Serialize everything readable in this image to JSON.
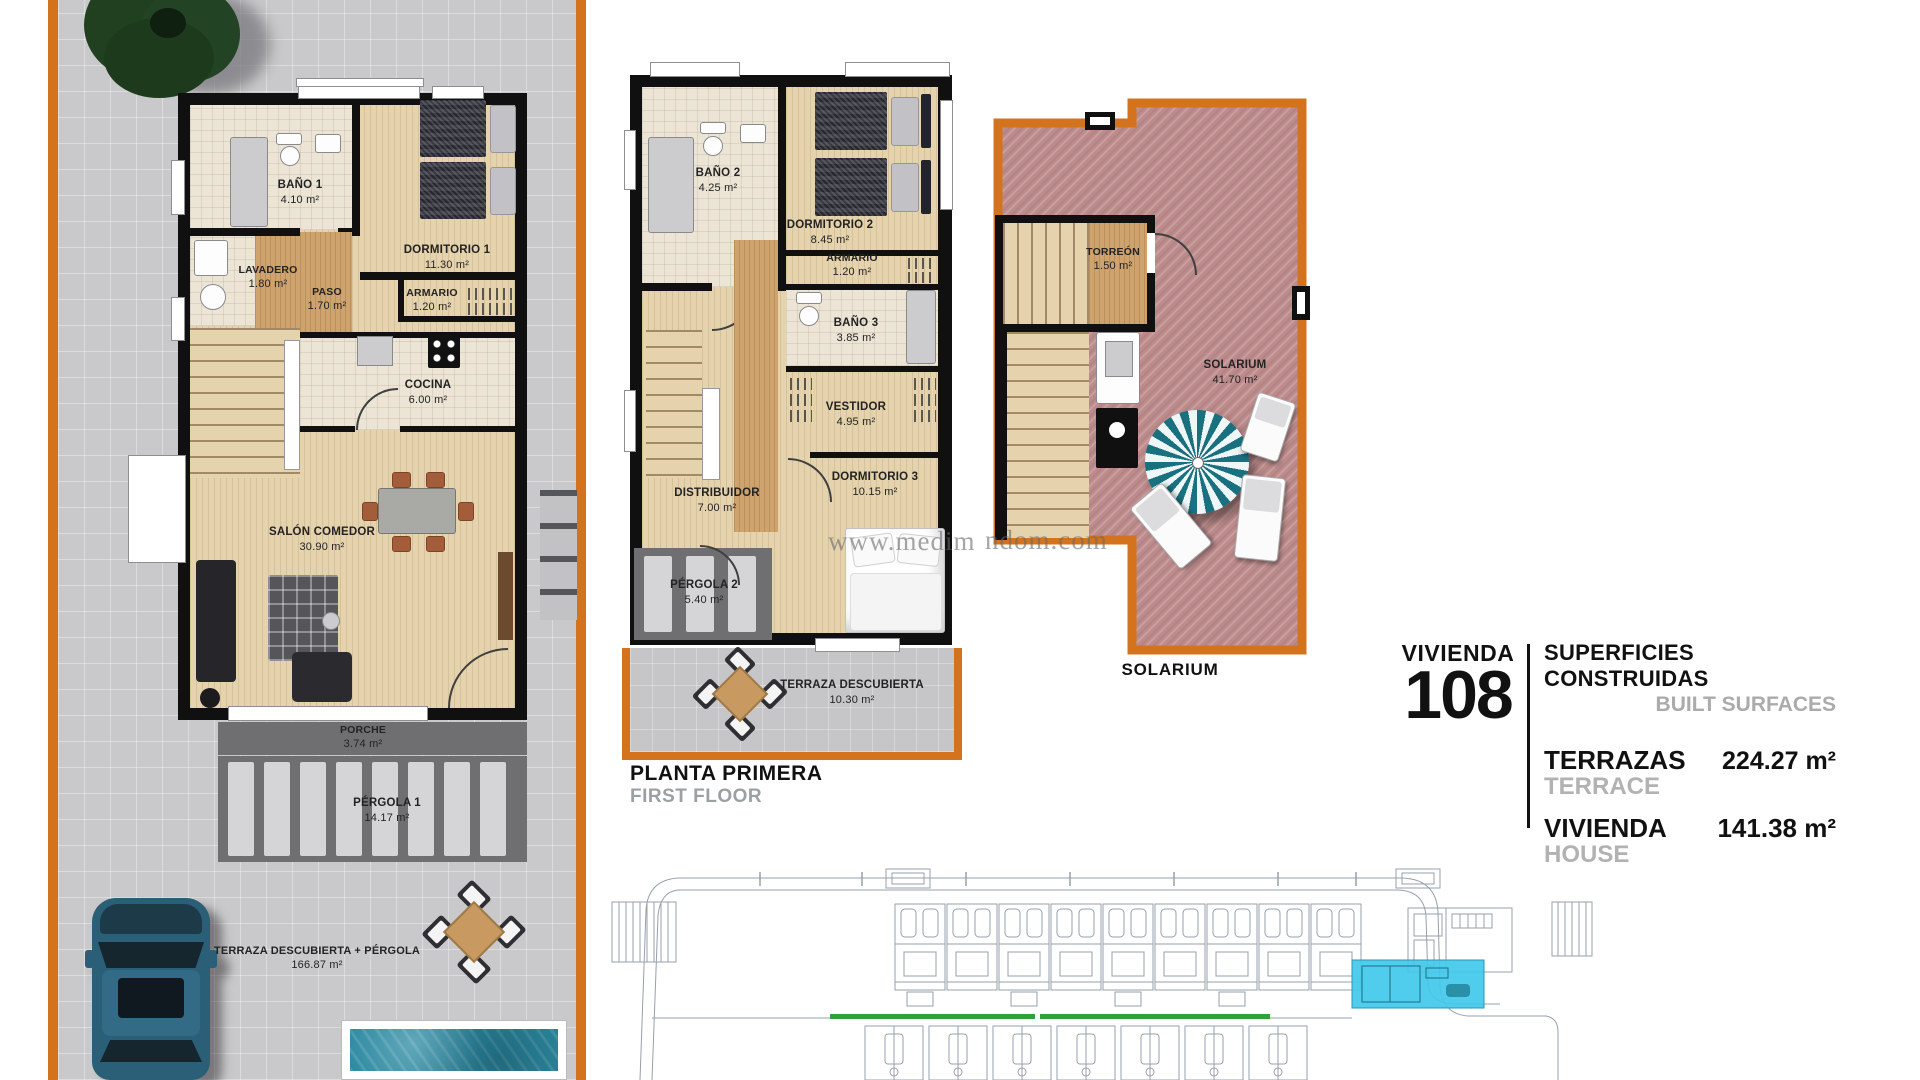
{
  "watermark": {
    "left": "www.medim",
    "right": "ndom.com"
  },
  "ground_floor": {
    "rooms": [
      {
        "name": "BAÑO 1",
        "area": "4.10 m²"
      },
      {
        "name": "LAVADERO",
        "area": "1.80 m²"
      },
      {
        "name": "PASO",
        "area": "1.70 m²"
      },
      {
        "name": "DORMITORIO 1",
        "area": "11.30 m²"
      },
      {
        "name": "ARMARIO",
        "area": "1.20 m²"
      },
      {
        "name": "COCINA",
        "area": "6.00 m²"
      },
      {
        "name": "SALÓN COMEDOR",
        "area": "30.90 m²"
      },
      {
        "name": "PORCHE",
        "area": "3.74 m²"
      },
      {
        "name": "PÉRGOLA 1",
        "area": "14.17 m²"
      },
      {
        "name": "TERRAZA DESCUBIERTA + PÉRGOLA",
        "area": "166.87 m²"
      }
    ]
  },
  "first_floor": {
    "title": "PLANTA PRIMERA",
    "title_en": "FIRST FLOOR",
    "rooms": [
      {
        "name": "BAÑO 2",
        "area": "4.25 m²"
      },
      {
        "name": "DORMITORIO 2",
        "area": "8.45 m²"
      },
      {
        "name": "ARMARIO",
        "area": "1.20 m²"
      },
      {
        "name": "BAÑO 3",
        "area": "3.85 m²"
      },
      {
        "name": "VESTIDOR",
        "area": "4.95 m²"
      },
      {
        "name": "DISTRIBUIDOR",
        "area": "7.00 m²"
      },
      {
        "name": "DORMITORIO 3",
        "area": "10.15 m²"
      },
      {
        "name": "PÉRGOLA 2",
        "area": "5.40 m²"
      },
      {
        "name": "TERRAZA DESCUBIERTA",
        "area": "10.30 m²"
      }
    ]
  },
  "solarium": {
    "caption": "SOLARIUM",
    "rooms": [
      {
        "name": "TORREÓN",
        "area": "1.50 m²"
      },
      {
        "name": "SOLARIUM",
        "area": "41.70 m²"
      }
    ]
  },
  "info": {
    "unit_label": "VIVIENDA",
    "unit_number": "108",
    "title": "SUPERFICIES CONSTRUIDAS",
    "title_en": "BUILT SURFACES",
    "rows": [
      {
        "label": "TERRAZAS",
        "label_en": "TERRACE",
        "value": "224.27 m²"
      },
      {
        "label": "VIVIENDA",
        "label_en": "HOUSE",
        "value": "141.38 m²"
      }
    ]
  },
  "colors": {
    "accent_orange": "#d4731e",
    "solarium_pink": "#bd8b8b",
    "highlight_cyan": "#41c8ea",
    "green_line": "#2fa23c"
  }
}
